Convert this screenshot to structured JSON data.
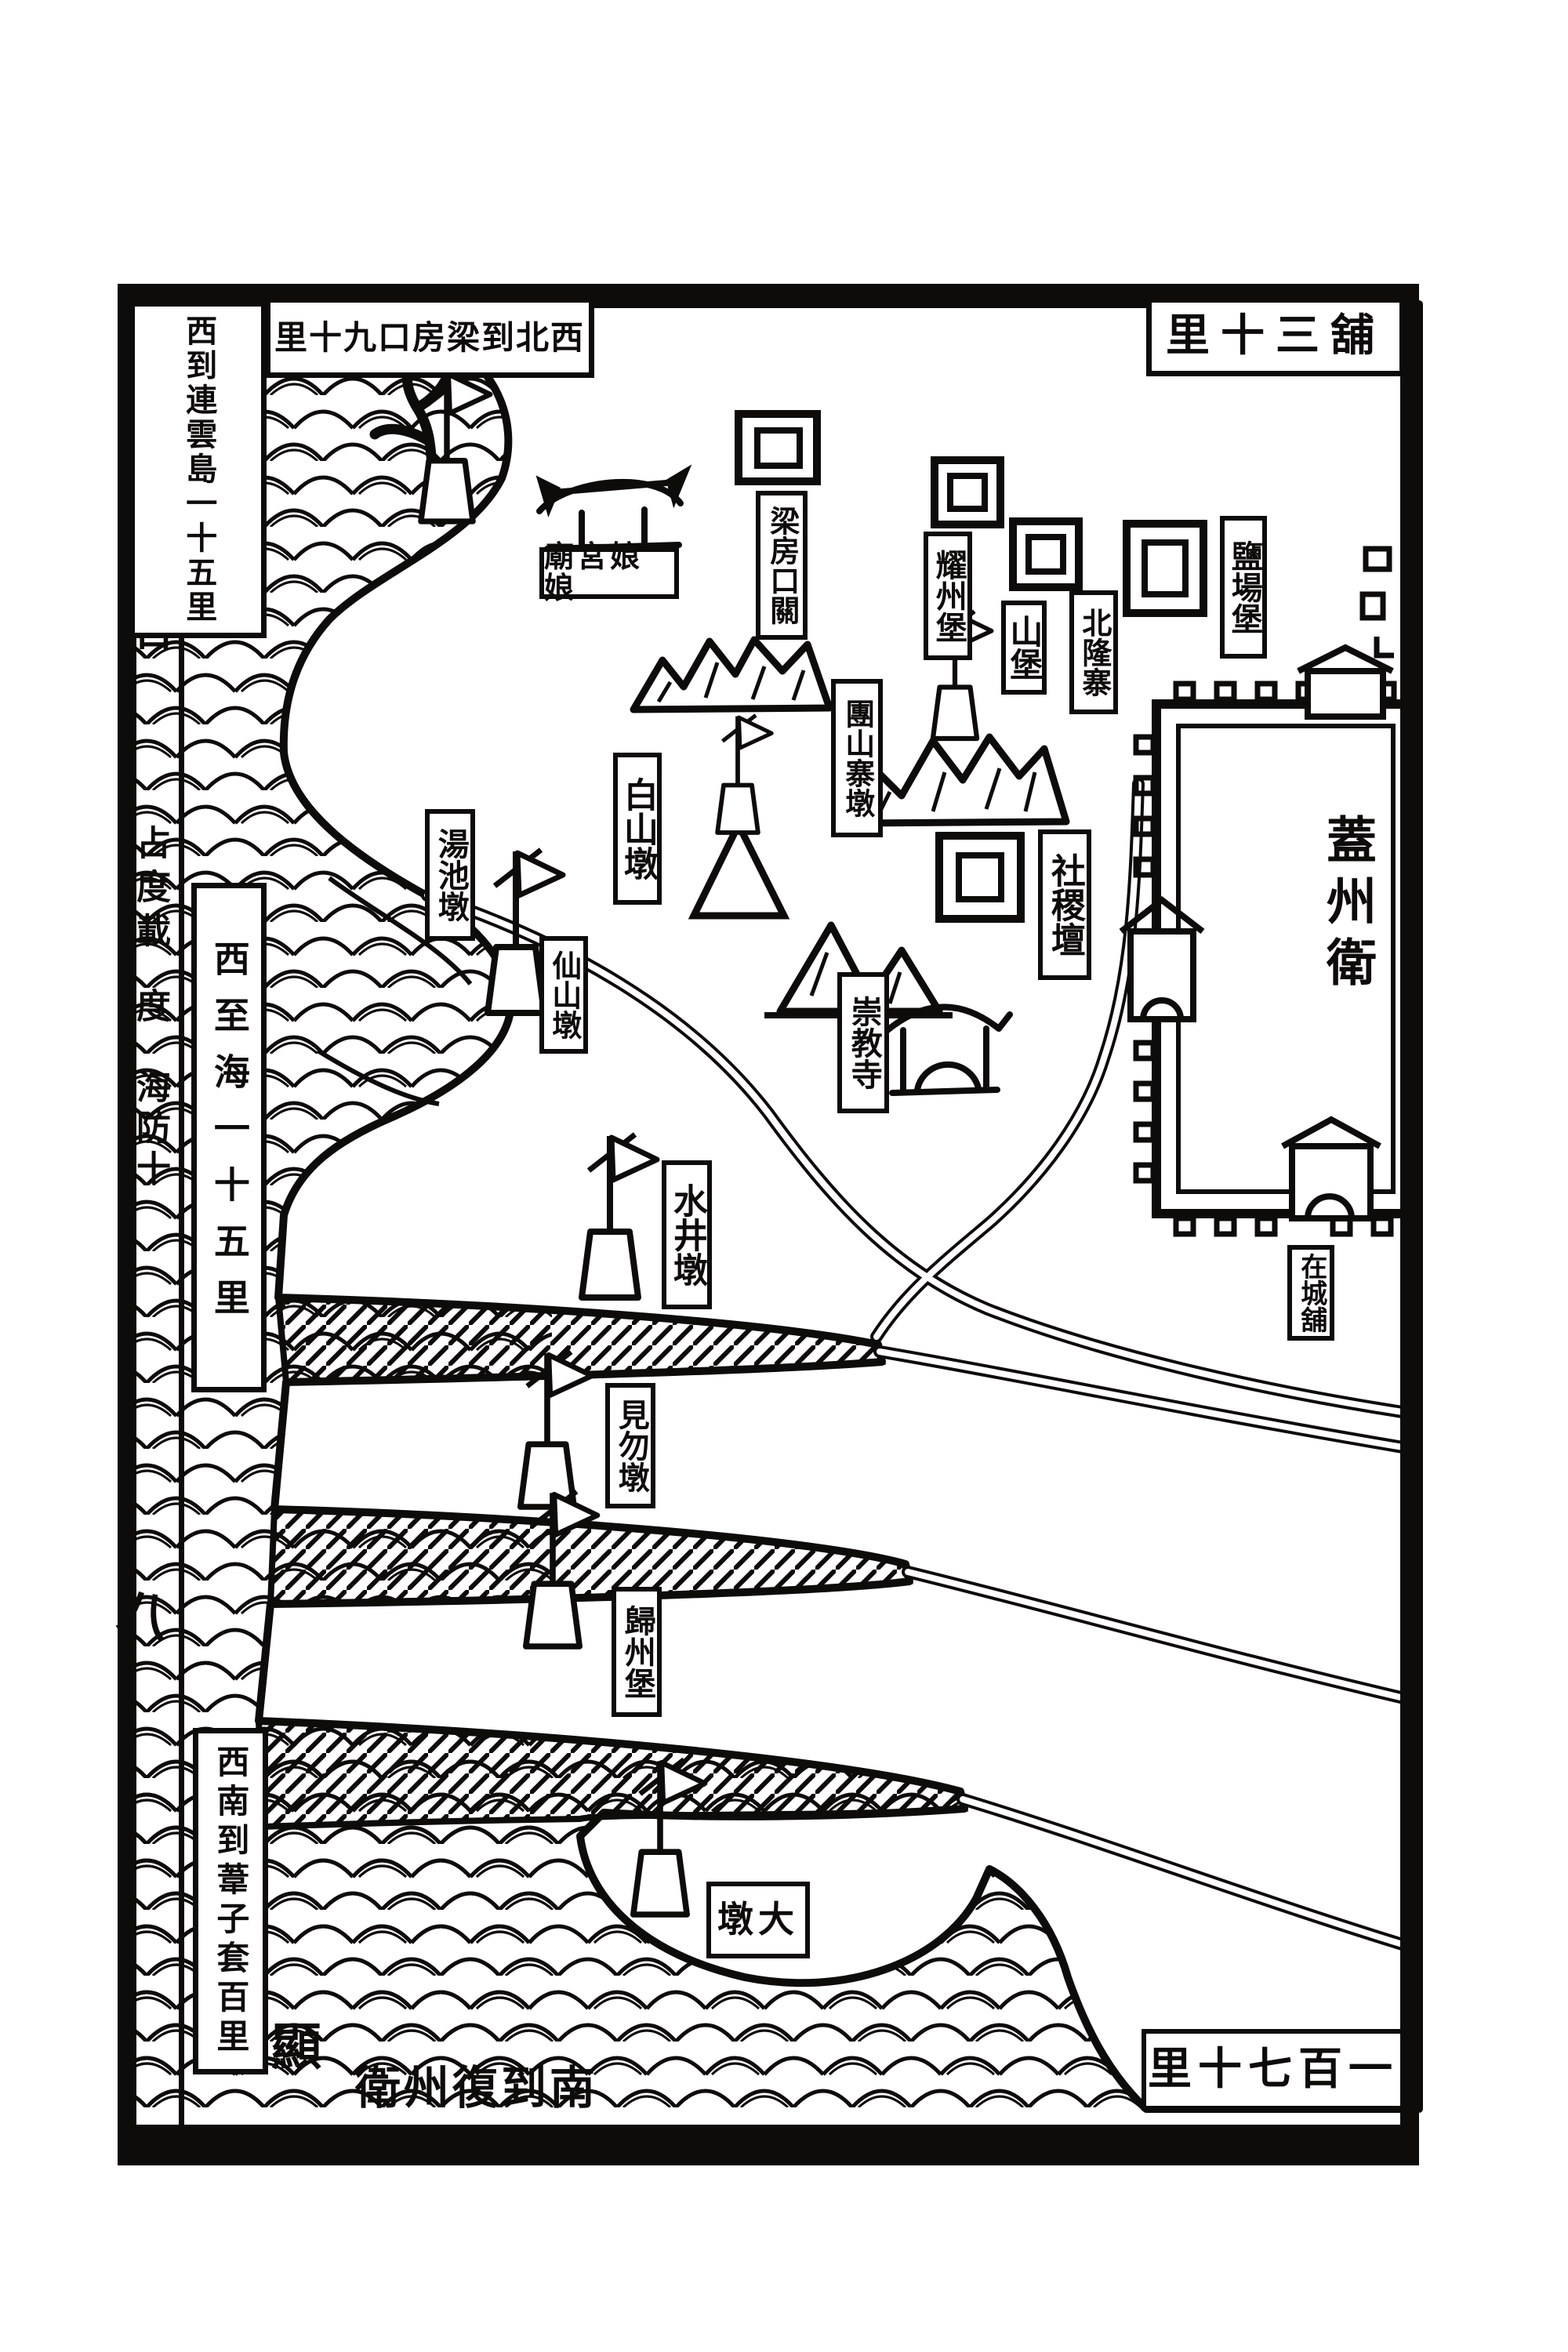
{
  "document": {
    "kind": "woodblock-printed coastal defense map page",
    "colors": {
      "ink": "#0d0c0a",
      "paper": "#ffffff"
    }
  },
  "margin_column": {
    "book_title": "武備志卷二百",
    "section": "占度載",
    "volume": "度",
    "part": "海防十",
    "page_number": "八"
  },
  "border_notes": {
    "top_left": {
      "text": "里十九口房梁到北西",
      "reading": "西北到梁房口九十里"
    },
    "top_right": {
      "text": "里十三舖",
      "reading": "舖三十里"
    },
    "left_upper": {
      "text": "西到連雲島一十五里"
    },
    "left_middle": {
      "text": "西至海一十五里"
    },
    "left_lower": {
      "text": "西南到葦子套百里"
    },
    "bottom_middle": {
      "text": "衛州復到南",
      "reading": "南到復州衛"
    },
    "bottom_right": {
      "text": "里十七百一",
      "reading": "一百七十里"
    },
    "shore_mark": {
      "text": "顯"
    }
  },
  "places": {
    "niangniang_gong": {
      "text": "廟宮娘娘",
      "reading": "娘娘宮廟",
      "kind": "temple"
    },
    "liangfangkou_guan": {
      "text": "梁房口關",
      "kind": "fort"
    },
    "yaozhou_bao": {
      "text": "耀州堡",
      "kind": "fort"
    },
    "shan_bao": {
      "text": "山堡",
      "kind": "fort"
    },
    "beilong_zhai": {
      "text": "北隆寨",
      "kind": "stockade"
    },
    "yanchang_bao": {
      "text": "鹽場堡",
      "kind": "fort"
    },
    "tuanshan_zhai_dun": {
      "text": "團山寨墩",
      "kind": "beacon"
    },
    "sheji_tan": {
      "text": "社稷壇",
      "kind": "altar"
    },
    "gaizhou_wei": {
      "text": "蓋州衛",
      "kind": "walled-garrison-city"
    },
    "baishan_dun": {
      "text": "白山墩",
      "kind": "beacon"
    },
    "tangchi_dun": {
      "text": "湯池墩",
      "kind": "beacon"
    },
    "xianshan_dun": {
      "text": "仙山墩",
      "kind": "beacon"
    },
    "chongjiao_si": {
      "text": "崇教寺",
      "kind": "temple"
    },
    "shuijing_dun": {
      "text": "水井墩",
      "kind": "beacon"
    },
    "jianwu_dun": {
      "text": "見勿墩",
      "kind": "beacon"
    },
    "guizhou_bao": {
      "text": "歸州堡",
      "kind": "fort"
    },
    "da_dun": {
      "text": "墩大",
      "reading": "大墩",
      "kind": "beacon"
    },
    "zaicheng_pu": {
      "text": "在城舖",
      "kind": "post-station"
    }
  },
  "icons": {
    "beacon-tower-icon": "pole with pennant flag on trapezoid mound",
    "fort-icon": "double nested square",
    "temple-icon": "roofed shrine",
    "city-wall-icon": "crenellated rectangle with gates",
    "mountain-icon": "jagged hatched peaks",
    "wave-icon": "scalloped sea waves",
    "channel-icon": "hatched tidal channel"
  }
}
